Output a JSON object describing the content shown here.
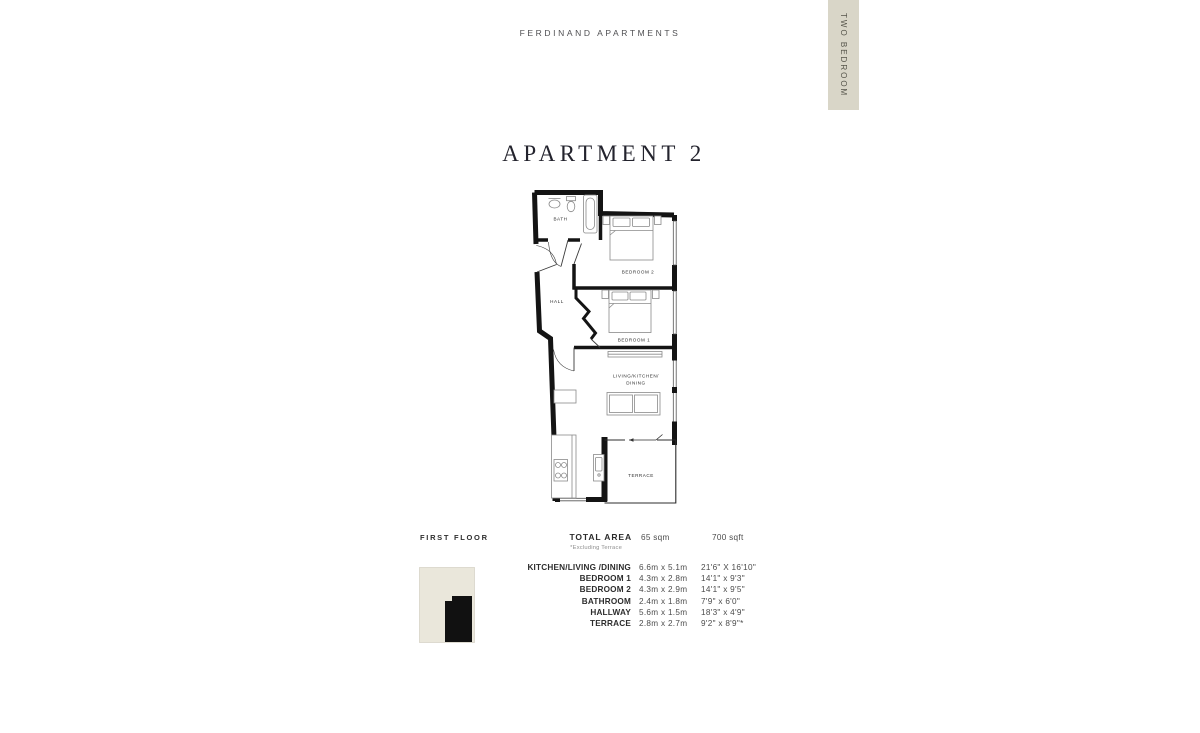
{
  "header": {
    "brand": "FERDINAND APARTMENTS",
    "tab_label": "TWO BEDROOM",
    "tab_bg": "#d9d6c8"
  },
  "title": "APARTMENT 2",
  "plan": {
    "labels": {
      "bath": "BATH",
      "bedroom2": "BEDROOM 2",
      "hall": "HALL",
      "bedroom1": "BEDROOM 1",
      "living1": "LIVING/KITCHEN/",
      "living2": "DINING",
      "terrace": "TERRACE"
    },
    "wall_color": "#141414"
  },
  "key_plan": {
    "floor_label": "FIRST FLOOR",
    "bg_color": "#eae7db",
    "highlight_color": "#111111"
  },
  "total_area": {
    "label": "TOTAL AREA",
    "metric": "65 sqm",
    "imperial": "700 sqft",
    "note": "*Excluding Terrace"
  },
  "dimensions": [
    {
      "room": "KITCHEN/LIVING /DINING",
      "metric": "6.6m x 5.1m",
      "imperial": "21'6\" X 16'10\""
    },
    {
      "room": "BEDROOM 1",
      "metric": "4.3m x 2.8m",
      "imperial": "14'1\" x 9'3\""
    },
    {
      "room": "BEDROOM 2",
      "metric": "4.3m x 2.9m",
      "imperial": "14'1\" x 9'5\""
    },
    {
      "room": "BATHROOM",
      "metric": "2.4m x 1.8m",
      "imperial": "7'9\" x 6'0\""
    },
    {
      "room": "HALLWAY",
      "metric": "5.6m x 1.5m",
      "imperial": "18'3\" x 4'9\""
    },
    {
      "room": "TERRACE",
      "metric": "2.8m x 2.7m",
      "imperial": "9'2\" x 8'9\"*"
    }
  ]
}
